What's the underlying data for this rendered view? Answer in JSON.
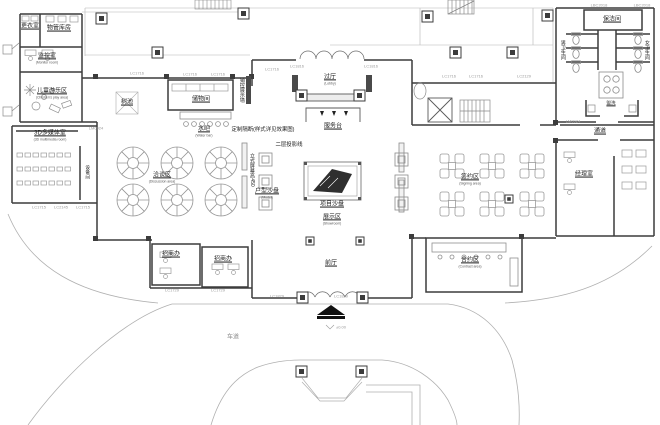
{
  "plan": {
    "rooms": {
      "changing_room": {
        "zh": "更衣室"
      },
      "property_storage": {
        "zh": "物管库房"
      },
      "monitor_room": {
        "zh": "监控室",
        "en": "(Monitor room)"
      },
      "kids_area": {
        "zh": "儿童游乐区",
        "en": "(Children's play area)"
      },
      "tree_pool": {
        "zh": "树池"
      },
      "storage_room": {
        "zh": "储物间"
      },
      "water_bar": {
        "zh": "水吧",
        "en": "(Water bar)"
      },
      "media_room": {
        "zh": "3D多媒体室",
        "en": "(3D multimedia room)"
      },
      "equipment_room": {
        "zh": "设备间"
      },
      "discussion_area": {
        "zh": "洽谈区",
        "en": "(Discussion area)"
      },
      "invest_office_1": {
        "zh": "招商办"
      },
      "invest_office_2": {
        "zh": "招商办"
      },
      "lobby": {
        "zh": "过厅",
        "en": "(Lobby)"
      },
      "service_desk": {
        "zh": "服务台"
      },
      "unit_model": {
        "zh": "户型沙盘",
        "en": "(Model)"
      },
      "project_model": {
        "zh": "项目沙盘"
      },
      "display_area": {
        "zh": "展示区",
        "en": "(Showroom)"
      },
      "front_hall": {
        "zh": "前厅"
      },
      "signing_area": {
        "zh": "签约区",
        "en": "(Signing area)"
      },
      "contract_area": {
        "zh": "合约区",
        "en": "(Contract area)"
      },
      "manager_room": {
        "zh": "经理室"
      },
      "passage": {
        "zh": "通道"
      },
      "cleaning_room": {
        "zh": "保洁间"
      },
      "mens_toilet": {
        "zh": "男卫生间"
      },
      "womens_toilet": {
        "zh": "女卫生间"
      },
      "washing": {
        "zh": "盥洗"
      },
      "driveway": {
        "zh": "车道"
      }
    },
    "annotations": {
      "custom_partition": "定制隔断(样式详见效果图)",
      "projection_line": "二层投影线",
      "vertical_screen": "立式屏幕高450",
      "sales_wall": "销控展示墙",
      "level_mark": "±0.00"
    },
    "window_tags": [
      "LC1716",
      "LC1716",
      "LC1716",
      "LC1716",
      "LC1816",
      "LC1816",
      "LC1716",
      "LC1716",
      "LC1729",
      "LC1729",
      "LC1829",
      "LC1829",
      "LC1715",
      "LC2145",
      "LC1715",
      "LBC2018",
      "LBC2018",
      "LM0924",
      "LM0924",
      "LC2129"
    ]
  }
}
